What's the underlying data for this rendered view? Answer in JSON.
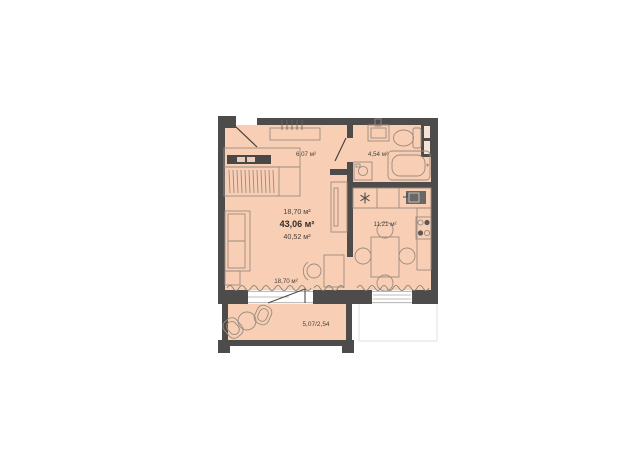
{
  "floor_plan": {
    "rooms": {
      "hallway": {
        "area": "6,07 м²"
      },
      "bathroom": {
        "area": "4,54 м²"
      },
      "kitchen": {
        "area": "11,21 м²"
      },
      "living_room": {
        "area": "18,70 м²"
      },
      "balcony": {
        "area": "5,07/2,54"
      }
    },
    "area_summary": {
      "lines": [
        "18,70 м²",
        "43,06 м²",
        "40,52 м²"
      ]
    },
    "symbols": {
      "fridge_snowflake": "✳"
    },
    "colors": {
      "walls": "#4e4c4a",
      "floor": "#f8cfb5",
      "furniture_stroke": "#9a8b80",
      "text": "#4a4238",
      "window": "#ffffff"
    }
  }
}
